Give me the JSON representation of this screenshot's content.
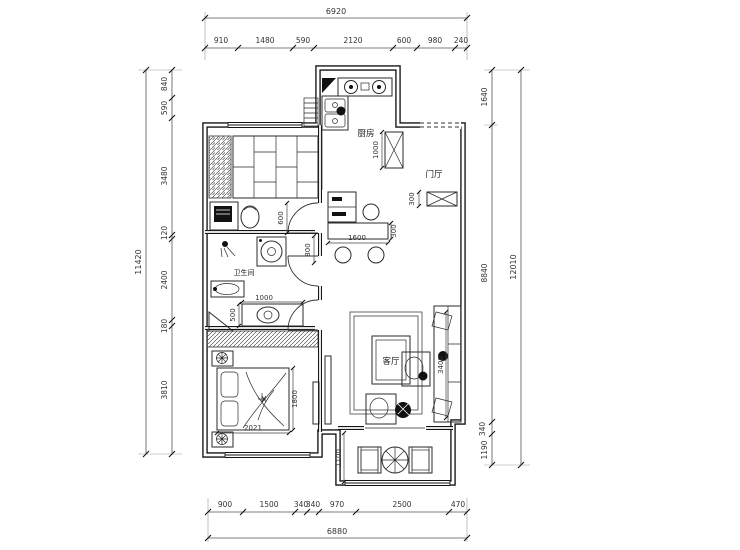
{
  "rooms": {
    "kitchen": "厨房",
    "entry": "门厅",
    "bathroom": "卫生间",
    "living": "客厅"
  },
  "dims": {
    "top": {
      "overall": "6920",
      "segments": [
        "910",
        "1480",
        "590",
        "2120",
        "600",
        "980",
        "240"
      ]
    },
    "bottom": {
      "overall": "6880",
      "segments": [
        "900",
        "1500",
        "340",
        "340",
        "970",
        "2500",
        "470"
      ]
    },
    "left": {
      "overall": "11420",
      "segments": [
        "840",
        "590",
        "3480",
        "120",
        "2400",
        "180",
        "3810"
      ]
    },
    "right": {
      "overall": "12010",
      "segments": [
        "1640",
        "8840",
        "340",
        "1190"
      ]
    },
    "interior": {
      "kitchen_cabinet": "1000",
      "entry_cabinet": "300",
      "study_door": "600",
      "hallway": "800",
      "dining_table_width": "1600",
      "dining_table_depth": "300",
      "toilet_width": "1000",
      "vanity_depth": "500",
      "bed_length": "1800",
      "bed_width": "2021",
      "sofa_wall": "3400",
      "balcony_depth": "1100"
    }
  }
}
